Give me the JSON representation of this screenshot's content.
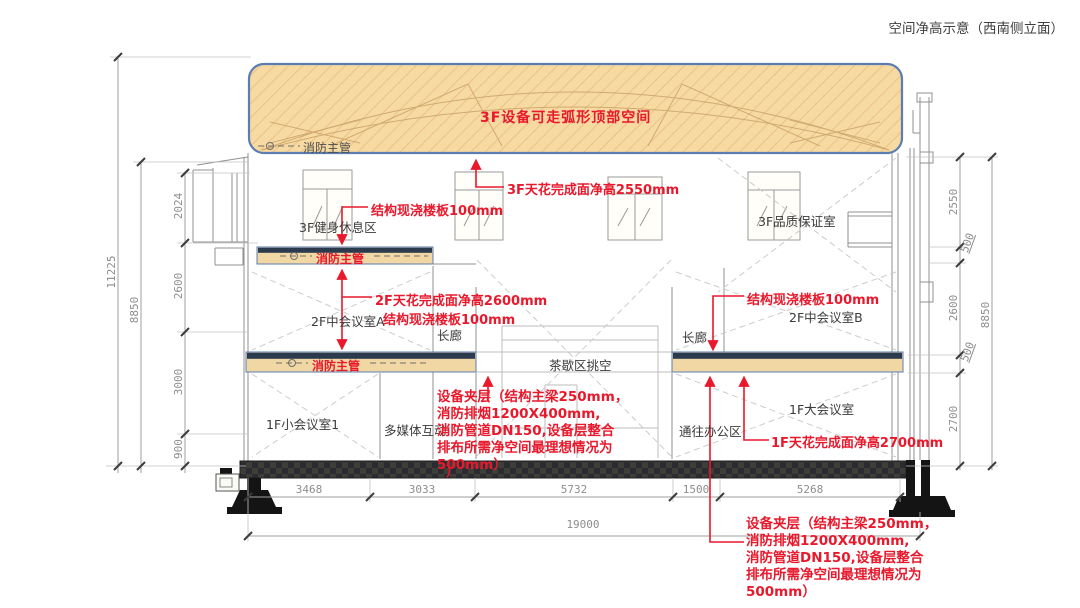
{
  "title": "空间净高示意（西南侧立面）",
  "roof": {
    "note": "3F设备可走弧形顶部空间"
  },
  "pipes": {
    "top": "消防主管",
    "slab3f": "消防主管",
    "slab2f": "消防主管"
  },
  "rooms": {
    "gym3f": "3F健身休息区",
    "qa3f": "3F品质保证室",
    "meetA": "2F中会议室A",
    "meetB": "2F中会议室B",
    "corridorL": "长廊",
    "corridorR": "长廊",
    "teaVoid": "茶歇区挑空",
    "small1f": "1F小会议室1",
    "multimedia": "多媒体互动",
    "toOffice": "通往办公区",
    "large1f": "1F大会议室"
  },
  "notes": {
    "slab_left_top": "结构现浇楼板100mm",
    "ceil3f": "3F天花完成面净高2550mm",
    "ceil2f": "2F天花完成面净高2600mm",
    "slab_left_mid": "结构现浇楼板100mm",
    "slab_right": "结构现浇楼板100mm",
    "ceil1f": "1F天花完成面净高2700mm",
    "equip_mid": "设备夹层（结构主梁250mm，\n消防排烟1200X400mm,\n消防管道DN150,设备层整合\n排布所需净空间最理想情况为\n500mm）",
    "equip_mid_tail": "）",
    "equip_bottom": "设备夹层（结构主梁250mm，\n消防排烟1200X400mm,\n消防管道DN150,设备层整合\n排布所需净空间最理想情况为\n500mm）"
  },
  "dims": {
    "left_total": "11225",
    "left_sub": "8850",
    "left_floors": [
      "2024",
      "2600",
      "3000",
      "900"
    ],
    "right_floors": [
      "2550",
      "500",
      "2600",
      "500",
      "2700"
    ],
    "right_total": "8850",
    "bottom_segments": [
      "3468",
      "3033",
      "5732",
      "1500",
      "5268"
    ],
    "bottom_total": "19000"
  },
  "colors": {
    "annotation_red": "#e8192c",
    "roof_fill": "#f7d9a2",
    "roof_border": "#5b7db1",
    "slab_fill": "#f0d7a4",
    "slab_cap": "#2c3a4e",
    "floor_dark": "#2b2b31",
    "line_gray": "#909090",
    "dim_gray": "#8d8d8d"
  }
}
